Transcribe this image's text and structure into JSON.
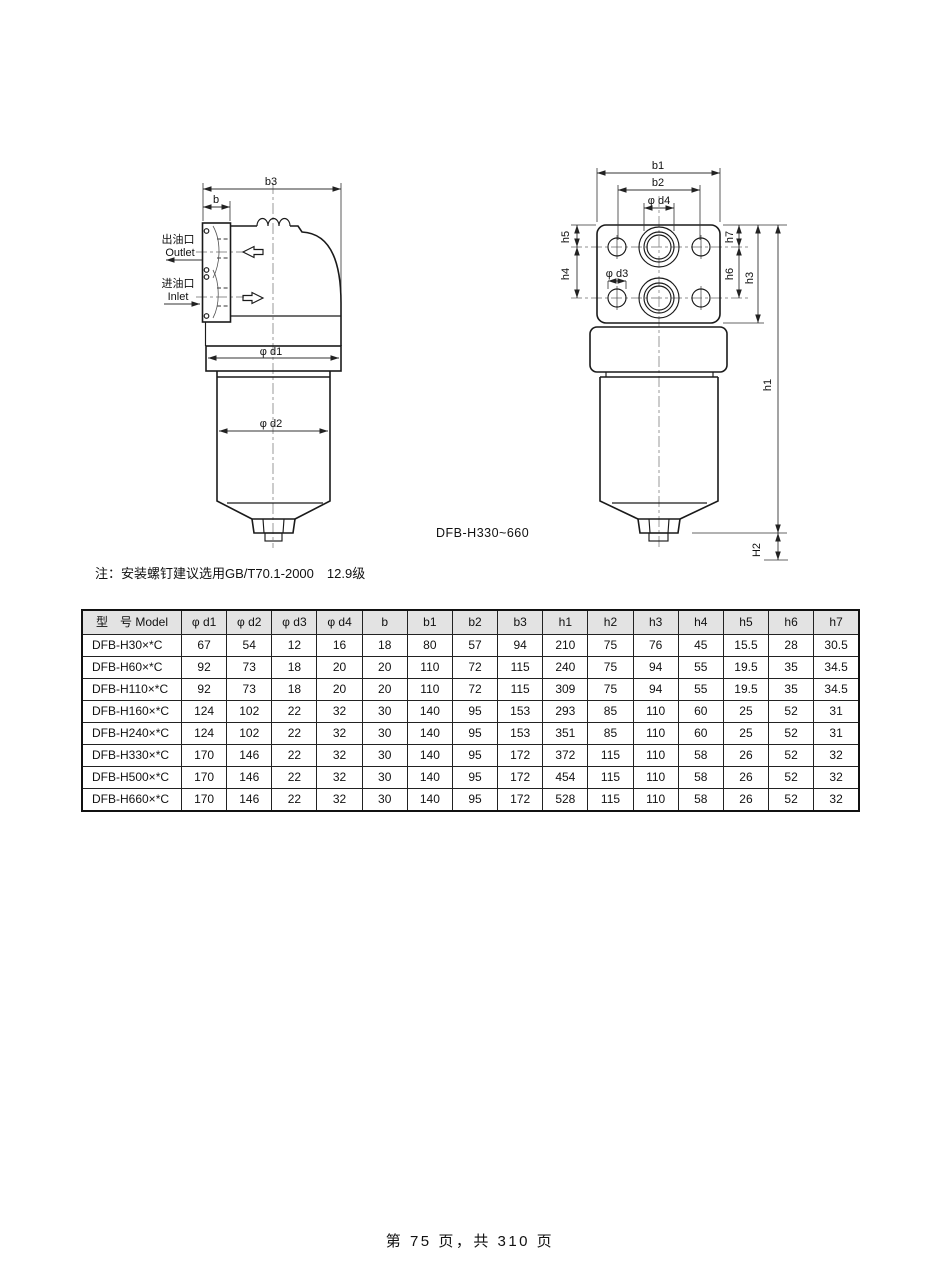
{
  "page": {
    "footer": "第 75 页，共 310 页"
  },
  "figure": {
    "caption": "DFB-H330~660",
    "note": "注：安装螺钉建议选用GB/T70.1-2000　12.9级",
    "left_view": {
      "outlet_cn": "出油口",
      "outlet_en": "Outlet",
      "inlet_cn": "进油口",
      "inlet_en": "Inlet",
      "dims": {
        "b3": "b3",
        "b": "b",
        "d1": "φ d1",
        "d2": "φ d2"
      }
    },
    "top_view": {
      "dims": {
        "b1": "b1",
        "b2": "b2",
        "d4": "φ d4",
        "d3": "φ d3",
        "h5": "h5",
        "h4": "h4",
        "h7": "h7",
        "h6": "h6",
        "h3": "h3",
        "h1": "h1",
        "h2": "H2"
      }
    }
  },
  "table": {
    "headers": [
      "型　号 Model",
      "φ d1",
      "φ d2",
      "φ d3",
      "φ d4",
      "b",
      "b1",
      "b2",
      "b3",
      "h1",
      "h2",
      "h3",
      "h4",
      "h5",
      "h6",
      "h7"
    ],
    "rows": [
      [
        "DFB-H30×*C",
        "67",
        "54",
        "12",
        "16",
        "18",
        "80",
        "57",
        "94",
        "210",
        "75",
        "76",
        "45",
        "15.5",
        "28",
        "30.5"
      ],
      [
        "DFB-H60×*C",
        "92",
        "73",
        "18",
        "20",
        "20",
        "110",
        "72",
        "115",
        "240",
        "75",
        "94",
        "55",
        "19.5",
        "35",
        "34.5"
      ],
      [
        "DFB-H110×*C",
        "92",
        "73",
        "18",
        "20",
        "20",
        "110",
        "72",
        "115",
        "309",
        "75",
        "94",
        "55",
        "19.5",
        "35",
        "34.5"
      ],
      [
        "DFB-H160×*C",
        "124",
        "102",
        "22",
        "32",
        "30",
        "140",
        "95",
        "153",
        "293",
        "85",
        "110",
        "60",
        "25",
        "52",
        "31"
      ],
      [
        "DFB-H240×*C",
        "124",
        "102",
        "22",
        "32",
        "30",
        "140",
        "95",
        "153",
        "351",
        "85",
        "110",
        "60",
        "25",
        "52",
        "31"
      ],
      [
        "DFB-H330×*C",
        "170",
        "146",
        "22",
        "32",
        "30",
        "140",
        "95",
        "172",
        "372",
        "115",
        "110",
        "58",
        "26",
        "52",
        "32"
      ],
      [
        "DFB-H500×*C",
        "170",
        "146",
        "22",
        "32",
        "30",
        "140",
        "95",
        "172",
        "454",
        "115",
        "110",
        "58",
        "26",
        "52",
        "32"
      ],
      [
        "DFB-H660×*C",
        "170",
        "146",
        "22",
        "32",
        "30",
        "140",
        "95",
        "172",
        "528",
        "115",
        "110",
        "58",
        "26",
        "52",
        "32"
      ]
    ]
  },
  "colors": {
    "line": "#1a1a1a",
    "dimension": "#333333",
    "centerline": "#8f8f8f",
    "table_header_bg": "#e3e3e3",
    "paper": "#ffffff"
  }
}
